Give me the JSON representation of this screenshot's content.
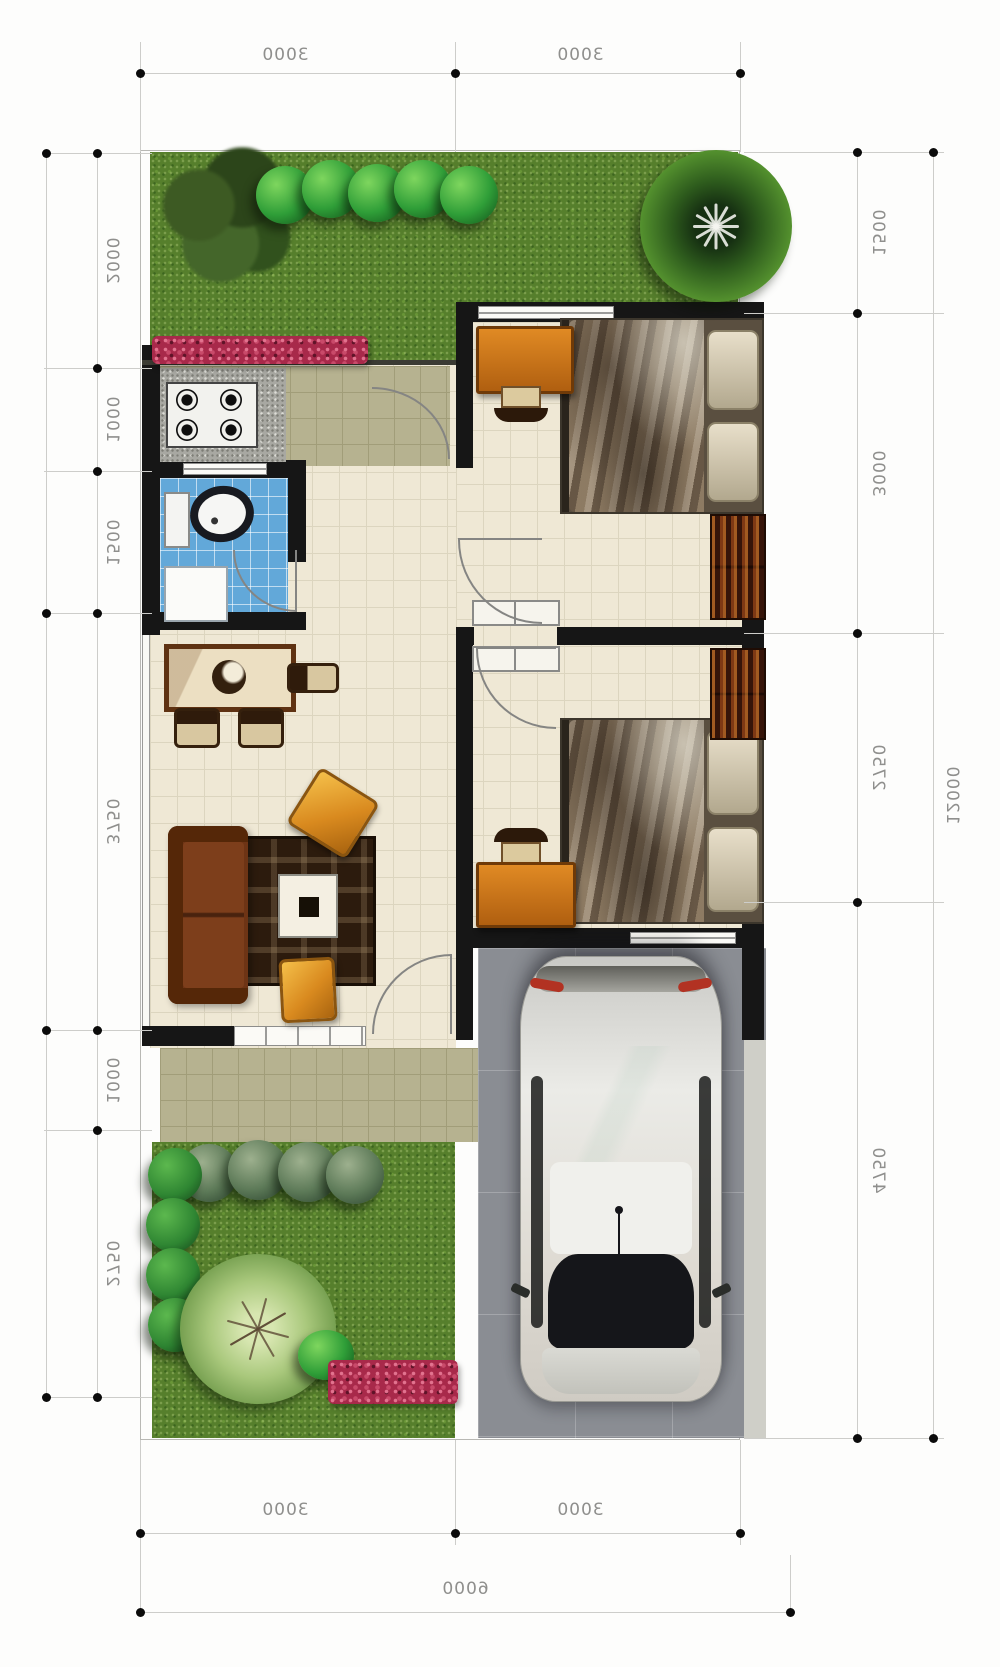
{
  "title": "house-floor-plan-6000x12000",
  "dimensions": {
    "top": [
      "3000",
      "3000"
    ],
    "bottom": [
      "3000",
      "3000"
    ],
    "bottom_total": "6000",
    "left": [
      "2000",
      "1000",
      "1500",
      "3750",
      "1000",
      "2750"
    ],
    "right": [
      "1500",
      "3000",
      "2750",
      "4750"
    ],
    "right_total": "12000"
  },
  "palette": {
    "wall": "#161616",
    "grass": "#567f2c",
    "interior_floor": "#efe8d5",
    "kitchen_tile": "#b6b290",
    "bathroom_tile": "#62a8d9",
    "carport": "#8a8d93",
    "flower_bed": "#a8294a",
    "sofa": "#6e3415",
    "furniture_accent": "#d98a1f",
    "dimension_line": "#cdcdca",
    "dimension_text": "#8f8f8d"
  }
}
